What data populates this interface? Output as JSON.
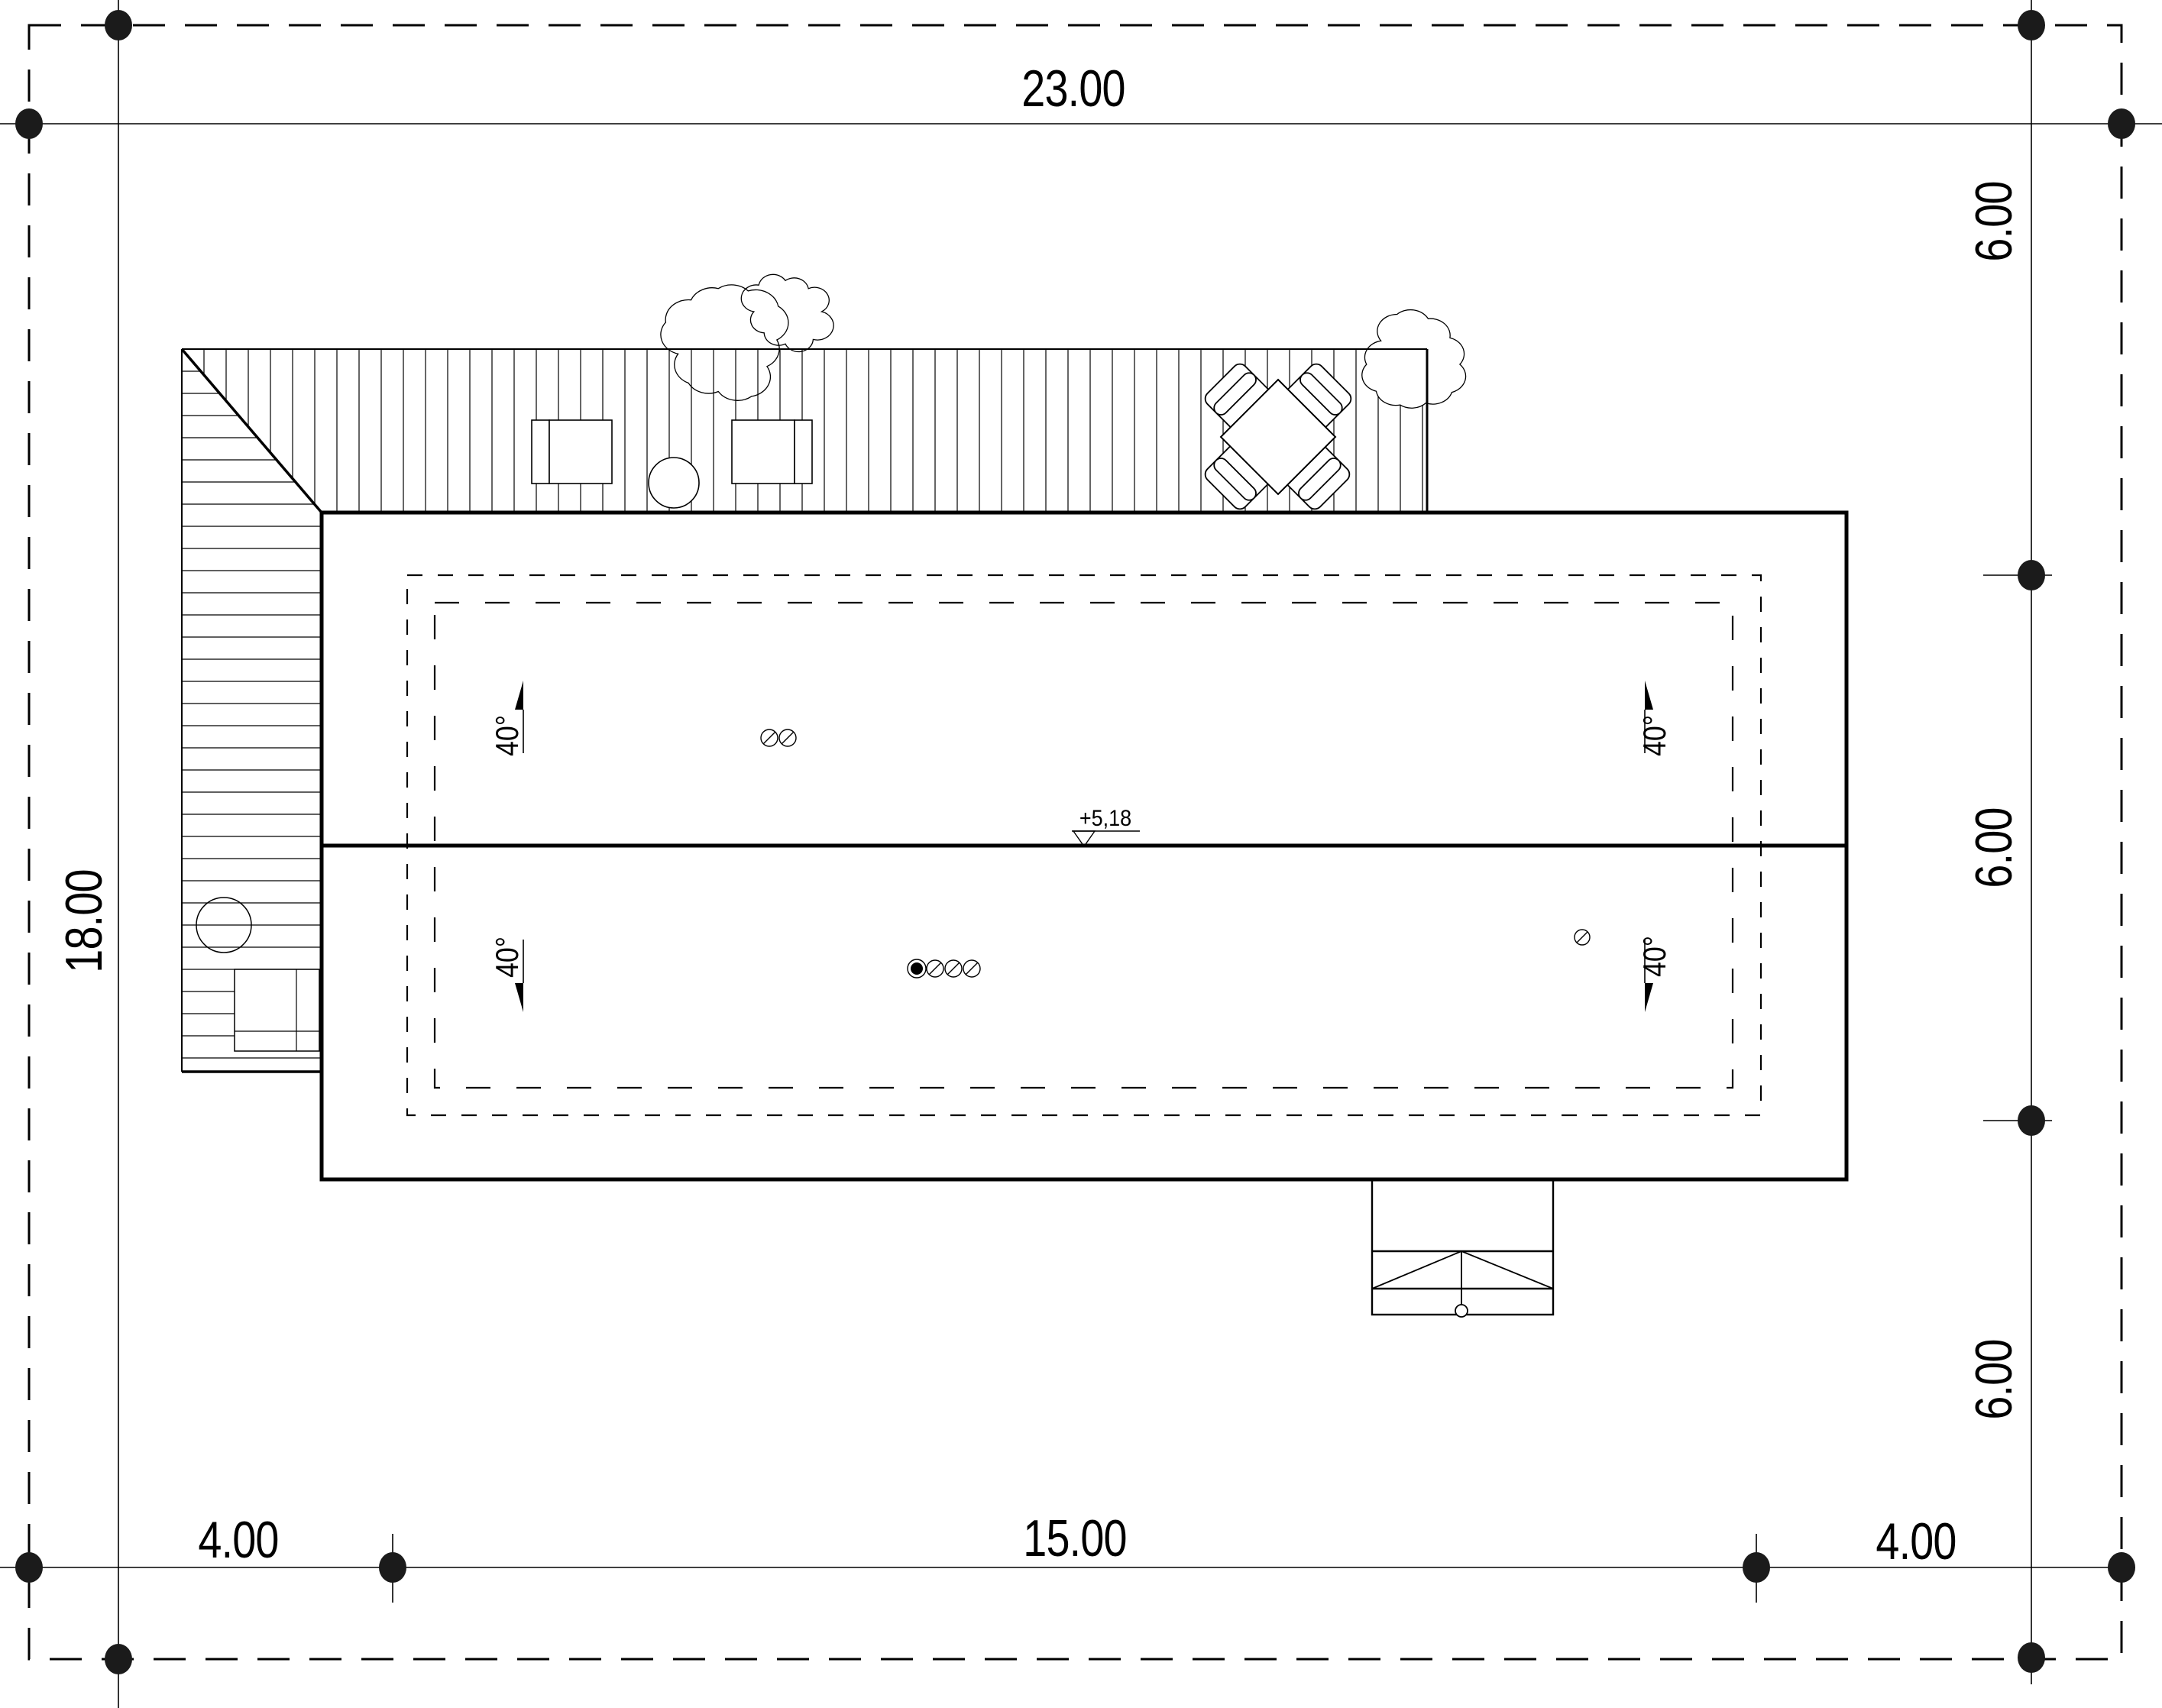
{
  "site_plan": {
    "dimensions": {
      "top_width": "23.00",
      "left_height": "18.00",
      "right_segments": [
        "6.00",
        "6.00",
        "6.00"
      ],
      "bottom_segments": [
        "4.00",
        "15.00",
        "4.00"
      ]
    },
    "roof": {
      "ridge_level_label": "+5,18",
      "slopes": [
        "40°",
        "40°",
        "40°",
        "40°"
      ]
    },
    "symbols": {
      "survey_marker": "filled-dot",
      "tree": "scalloped-circle",
      "roof_vent_open": "slashed-circle",
      "roof_vent_closed": "filled-circle",
      "level_marker": "open-triangle-icon"
    },
    "colors": {
      "ink": "#000000",
      "paper": "#ffffff"
    }
  }
}
